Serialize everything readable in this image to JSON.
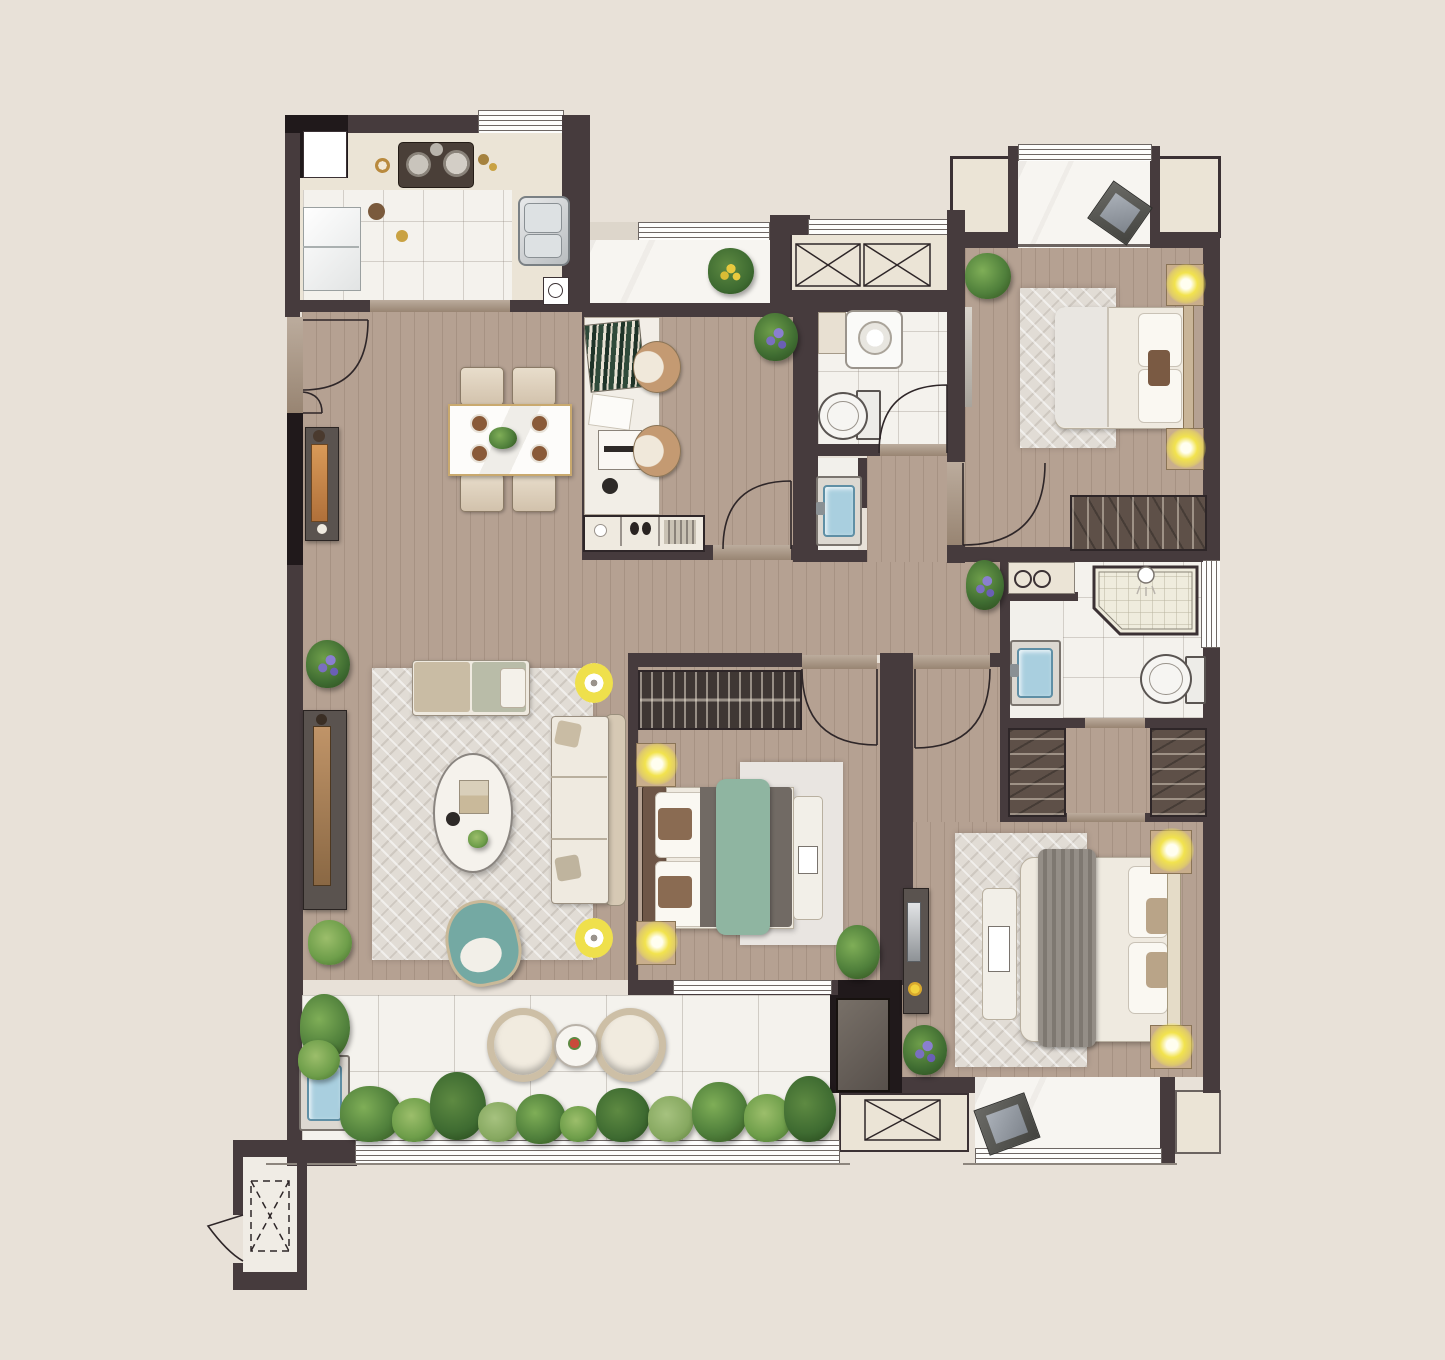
{
  "title": "apartment-floor-plan",
  "palette": {
    "bg": "#E8E1D8",
    "wall": "#463B3D",
    "blk": "#20191B",
    "wood": "#B5A192",
    "tile": "#F4F2ED",
    "marble": "#F7F5F1",
    "counter": "#EBE4D6",
    "rug": "#E1DCD5",
    "thresh": "#A5907C",
    "lamp": "#EFE04C",
    "teal": "#74A9A3",
    "bedgreen": "#8FB5A1",
    "blue": "#A9CFDF",
    "wardrobe": "#5E5048",
    "darkfurn": "#5A534F",
    "tan": "#C9AE8C",
    "cream": "#EFEAE0"
  },
  "rooms": [
    {
      "name": "kitchen",
      "furniture": [
        "fridge",
        "gas-stove",
        "double-sink",
        "counter",
        "tiled-floor",
        "floor-drain"
      ]
    },
    {
      "name": "living-dining-room",
      "furniture": [
        "dining-table",
        "four-dining-chairs",
        "sideboard",
        "tv-console",
        "area-rug",
        "sofa",
        "daybed-bench",
        "oval-coffee-table",
        "teal-armchair",
        "two-floor-lamps",
        "plants"
      ]
    },
    {
      "name": "study",
      "furniture": [
        "desk",
        "books",
        "laptop",
        "two-chairs",
        "low-cabinet",
        "plant"
      ]
    },
    {
      "name": "bathroom-1",
      "furniture": [
        "washing-machine",
        "shelf",
        "toilet",
        "washbasin"
      ]
    },
    {
      "name": "bedroom-top-right",
      "furniture": [
        "double-bed",
        "rug",
        "two-nightstand-lamps",
        "wardrobe",
        "balcony-with-cushion",
        "plant"
      ]
    },
    {
      "name": "bedroom-middle",
      "furniture": [
        "double-bed-green-runner",
        "bookshelf",
        "rug",
        "foot-bench",
        "two-nightstand-lamps",
        "plant"
      ]
    },
    {
      "name": "master-suite",
      "furniture": [
        "laundry-counter",
        "washbasin",
        "walk-in-shower",
        "toilet",
        "walk-in-closet-two-wardrobes",
        "double-bed-gray-runner",
        "rug",
        "bench",
        "two-nightstand-lamps",
        "console",
        "plant",
        "bay-window",
        "balcony-with-cushion"
      ]
    },
    {
      "name": "balcony-bottom",
      "furniture": [
        "two-round-chairs",
        "round-table",
        "planting-bed",
        "wash-sink"
      ]
    },
    {
      "name": "elevator",
      "furniture": [
        "elevator-shaft"
      ]
    }
  ],
  "doors": [
    "entry-double-door",
    "kitchen-sliding",
    "study-door",
    "bathroom-door",
    "bedroom-right-door",
    "bedroom-middle-door",
    "master-corridor-door",
    "elevator-door"
  ],
  "windows": [
    "kitchen-top",
    "balcony-top-middle",
    "ac-platform-louver",
    "bedroom-right-balcony",
    "shower-side",
    "bedroom-middle-bottom",
    "balcony-bottom-sill",
    "master-balcony-sill"
  ]
}
